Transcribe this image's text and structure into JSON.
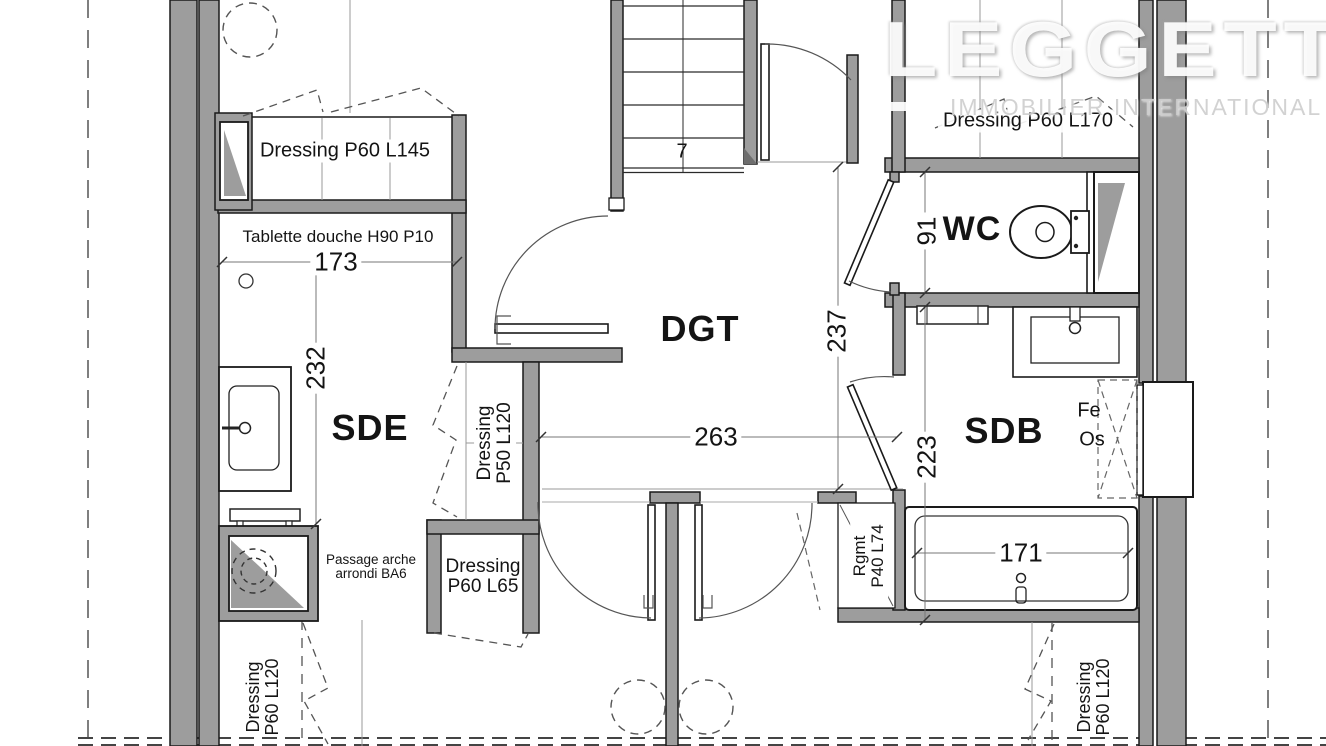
{
  "labels": {
    "rooms": {
      "sde": "SDE",
      "dgt": "DGT",
      "sdb": "SDB",
      "wc": "WC"
    },
    "closets": {
      "d145": "Dressing P60 L145",
      "d170": "Dressing P60 L170",
      "p50": "Dressing P50 L120",
      "p65": "Dressing P60 L65",
      "left120": "Dressing P60 L120",
      "right120": "Dressing P60 L120",
      "rgmt": "Rgmt P40 L74"
    },
    "notes": {
      "tablette": "Tablette douche H90 P10",
      "passage": "Passage arche arrondi BA6",
      "fe": "Fe",
      "os": "Os",
      "stair_count": "7"
    },
    "dimensions": {
      "w173": "173",
      "h232": "232",
      "w263": "263",
      "h237": "237",
      "h223": "223",
      "h91": "91",
      "w171": "171"
    }
  },
  "logo": {
    "name": "LEGGETT",
    "tagline": "IMMOBILIER INTERNATIONAL"
  },
  "colors": {
    "wall_fill": "#9d9d9d",
    "wall_outline": "#1a1a1a",
    "background": "#ffffff",
    "dash_line": "#555555",
    "watermark": "#ffffff"
  }
}
